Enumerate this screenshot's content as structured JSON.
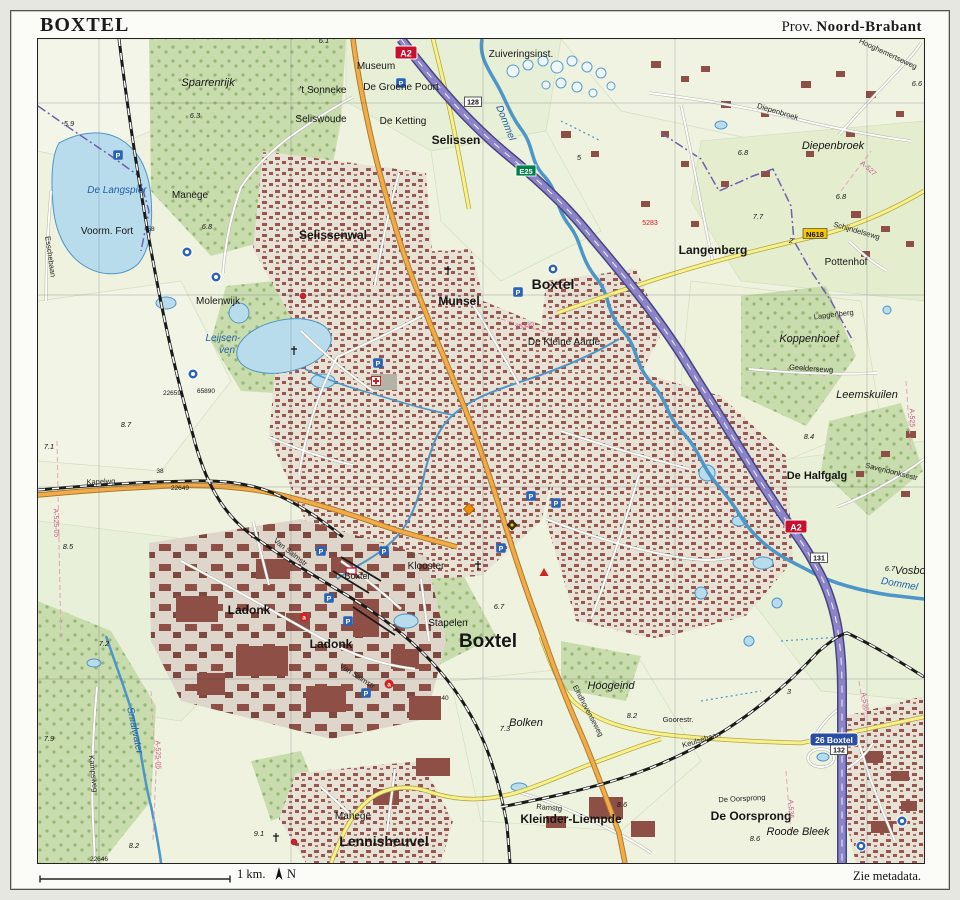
{
  "page": {
    "title": "BOXTEL",
    "province_prefix": "Prov.",
    "province": "Noord-Brabant",
    "scale_label": "1 km.",
    "north_label": "N",
    "metadata_note": "Zie metadata."
  },
  "colors": {
    "field": "#eef2de",
    "forest": "#c9dcae",
    "urban": "#e8e1d6",
    "building": "#8d4f46",
    "water_fill": "#b9dcec",
    "water_line": "#4e96c8",
    "motorway": "#8d83c9",
    "main_road": "#f3ab4a",
    "secondary_road": "#f7f08c",
    "railway": "#1a1a1a",
    "boundary": "#6f5fb0",
    "water_label": "#1f5fa8",
    "motorway_shield": "#c8102e",
    "eroad_shield": "#00804a",
    "nroad_shield": "#f6c800",
    "exit_sign": "#2b4ea2"
  },
  "map": {
    "labels": [
      {
        "text": "Sparrenrijk",
        "x": 207,
        "y": 85,
        "cls": "area"
      },
      {
        "text": "Museum",
        "x": 375,
        "y": 68,
        "cls": "hamlet"
      },
      {
        "text": "'t Sonneke",
        "x": 322,
        "y": 92,
        "cls": "hamlet"
      },
      {
        "text": "De Groene Poort",
        "x": 400,
        "y": 89,
        "cls": "hamlet"
      },
      {
        "text": "Seliswoude",
        "x": 320,
        "y": 121,
        "cls": "hamlet"
      },
      {
        "text": "De Ketting",
        "x": 402,
        "y": 123,
        "cls": "hamlet"
      },
      {
        "text": "Selissen",
        "x": 455,
        "y": 143,
        "cls": "village"
      },
      {
        "text": "Zuiveringsinst.",
        "x": 520,
        "y": 56,
        "cls": "hamlet"
      },
      {
        "text": "Manege",
        "x": 189,
        "y": 197,
        "cls": "hamlet"
      },
      {
        "text": "Voorm. Fort",
        "x": 106,
        "y": 233,
        "cls": "hamlet"
      },
      {
        "text": "De Langspier",
        "x": 116,
        "y": 192,
        "cls": "water"
      },
      {
        "text": "Selissenwal",
        "x": 332,
        "y": 238,
        "cls": "village"
      },
      {
        "text": "Molenwijk",
        "x": 217,
        "y": 303,
        "cls": "hamlet"
      },
      {
        "text": "Leijsen-",
        "x": 222,
        "y": 340,
        "cls": "water"
      },
      {
        "text": "ven",
        "x": 226,
        "y": 352,
        "cls": "water"
      },
      {
        "text": "Munsel",
        "x": 458,
        "y": 304,
        "cls": "village"
      },
      {
        "text": "Boxtel",
        "x": 552,
        "y": 288,
        "cls": "town-lg"
      },
      {
        "text": "De Kleine Aarde",
        "x": 563,
        "y": 344,
        "cls": "hamlet"
      },
      {
        "text": "Langenberg",
        "x": 712,
        "y": 253,
        "cls": "village"
      },
      {
        "text": "Pottenhof",
        "x": 845,
        "y": 264,
        "cls": "hamlet"
      },
      {
        "text": "Diepenbroek",
        "x": 832,
        "y": 148,
        "cls": "area"
      },
      {
        "text": "Koppenhoef",
        "x": 808,
        "y": 341,
        "cls": "area"
      },
      {
        "text": "Leemskuilen",
        "x": 866,
        "y": 397,
        "cls": "area"
      },
      {
        "text": "De Halfgalg",
        "x": 816,
        "y": 478,
        "cls": "subarea"
      },
      {
        "text": "Klooster",
        "x": 425,
        "y": 568,
        "cls": "hamlet"
      },
      {
        "text": "Stapelen",
        "x": 447,
        "y": 625,
        "cls": "hamlet"
      },
      {
        "text": "Boxtel",
        "x": 487,
        "y": 646,
        "cls": "town-xl"
      },
      {
        "text": "Ladonk",
        "x": 248,
        "y": 613,
        "cls": "village"
      },
      {
        "text": "Ladonk",
        "x": 330,
        "y": 647,
        "cls": "village"
      },
      {
        "text": "Boxtel",
        "x": 356,
        "y": 578,
        "cls": "station-lbl"
      },
      {
        "text": "Hoogeind",
        "x": 610,
        "y": 688,
        "cls": "area"
      },
      {
        "text": "Bolken",
        "x": 525,
        "y": 725,
        "cls": "area"
      },
      {
        "text": "Goorestr.",
        "x": 677,
        "y": 721,
        "cls": "street"
      },
      {
        "text": "Kleinder-Liempde",
        "x": 570,
        "y": 822,
        "cls": "village"
      },
      {
        "text": "Lennisheuvel",
        "x": 383,
        "y": 845,
        "cls": "town-lg"
      },
      {
        "text": "Manege",
        "x": 352,
        "y": 818,
        "cls": "hamlet"
      },
      {
        "text": "De Oorsprong",
        "x": 750,
        "y": 819,
        "cls": "village"
      },
      {
        "text": "Roode Bleek",
        "x": 797,
        "y": 834,
        "cls": "area"
      },
      {
        "text": "Vosbos",
        "x": 912,
        "y": 573,
        "cls": "area"
      },
      {
        "text": "Dommel",
        "x": 502,
        "y": 123,
        "cls": "water",
        "rot": 68
      },
      {
        "text": "Dommel",
        "x": 898,
        "y": 586,
        "cls": "water",
        "rot": 10
      },
      {
        "text": "Smalwater",
        "x": 131,
        "y": 730,
        "cls": "water",
        "rot": 78
      },
      {
        "text": "Hooghemertseweg",
        "x": 886,
        "y": 55,
        "cls": "street",
        "rot": 25
      },
      {
        "text": "Diepenbroek",
        "x": 776,
        "y": 113,
        "cls": "street",
        "rot": 17
      },
      {
        "text": "Schijndelsewg",
        "x": 855,
        "y": 232,
        "cls": "street",
        "rot": 16
      },
      {
        "text": "Langenberg",
        "x": 833,
        "y": 316,
        "cls": "street",
        "rot": -7
      },
      {
        "text": "Geeldersewg",
        "x": 810,
        "y": 370,
        "cls": "street",
        "rot": 4
      },
      {
        "text": "Savendonksestr",
        "x": 890,
        "y": 473,
        "cls": "street",
        "rot": 14
      },
      {
        "text": "Kapelwg",
        "x": 100,
        "y": 483,
        "cls": "street",
        "rot": -2
      },
      {
        "text": "Esschebaan",
        "x": 47,
        "y": 256,
        "cls": "street",
        "rot": 82
      },
      {
        "text": "Kampsweg",
        "x": 90,
        "y": 773,
        "cls": "street",
        "rot": 84
      },
      {
        "text": "Eindhovenseweg",
        "x": 585,
        "y": 711,
        "cls": "street",
        "rot": 62
      },
      {
        "text": "Keulsebaan",
        "x": 701,
        "y": 741,
        "cls": "street",
        "rot": -17
      },
      {
        "text": "Van Salmstr",
        "x": 288,
        "y": 553,
        "cls": "street",
        "rot": 38
      },
      {
        "text": "Van Salmstr",
        "x": 355,
        "y": 677,
        "cls": "street",
        "rot": 33
      },
      {
        "text": "Ramstg",
        "x": 548,
        "y": 809,
        "cls": "street",
        "rot": 5
      },
      {
        "text": "De Oorsprong",
        "x": 741,
        "y": 800,
        "cls": "street",
        "rot": -3
      },
      {
        "text": "6.1",
        "x": 323,
        "y": 42,
        "cls": "spot"
      },
      {
        "text": "5.9",
        "x": 68,
        "y": 125,
        "cls": "spot"
      },
      {
        "text": "6.3",
        "x": 194,
        "y": 117,
        "cls": "spot"
      },
      {
        "text": "5",
        "x": 578,
        "y": 159,
        "cls": "spot"
      },
      {
        "text": "6.8",
        "x": 742,
        "y": 154,
        "cls": "spot"
      },
      {
        "text": "6.8",
        "x": 840,
        "y": 198,
        "cls": "spot"
      },
      {
        "text": "7.7",
        "x": 757,
        "y": 218,
        "cls": "spot"
      },
      {
        "text": "6.8",
        "x": 206,
        "y": 228,
        "cls": "spot"
      },
      {
        "text": "8.7",
        "x": 125,
        "y": 426,
        "cls": "spot"
      },
      {
        "text": "7.1",
        "x": 48,
        "y": 448,
        "cls": "spot"
      },
      {
        "text": "8.5",
        "x": 67,
        "y": 548,
        "cls": "spot"
      },
      {
        "text": "8.4",
        "x": 808,
        "y": 438,
        "cls": "spot"
      },
      {
        "text": "6.7",
        "x": 498,
        "y": 608,
        "cls": "spot"
      },
      {
        "text": "6.7",
        "x": 889,
        "y": 570,
        "cls": "spot"
      },
      {
        "text": "7.2",
        "x": 103,
        "y": 645,
        "cls": "spot"
      },
      {
        "text": "7.9",
        "x": 48,
        "y": 740,
        "cls": "spot"
      },
      {
        "text": "8.2",
        "x": 133,
        "y": 847,
        "cls": "spot"
      },
      {
        "text": "8.2",
        "x": 631,
        "y": 717,
        "cls": "spot"
      },
      {
        "text": "7.3",
        "x": 504,
        "y": 730,
        "cls": "spot"
      },
      {
        "text": "8.6",
        "x": 621,
        "y": 806,
        "cls": "spot"
      },
      {
        "text": "8.6",
        "x": 754,
        "y": 840,
        "cls": "spot"
      },
      {
        "text": "9.1",
        "x": 258,
        "y": 835,
        "cls": "spot"
      },
      {
        "text": "6.6",
        "x": 916,
        "y": 85,
        "cls": "spot"
      },
      {
        "text": "2",
        "x": 790,
        "y": 242,
        "cls": "spot"
      },
      {
        "text": "3",
        "x": 788,
        "y": 693,
        "cls": "spot"
      },
      {
        "text": "58",
        "x": 150,
        "y": 230,
        "cls": "tiny"
      },
      {
        "text": "38",
        "x": 159,
        "y": 472,
        "cls": "tiny"
      },
      {
        "text": "40",
        "x": 444,
        "y": 699,
        "cls": "tiny"
      },
      {
        "text": "22659",
        "x": 171,
        "y": 394,
        "cls": "tiny"
      },
      {
        "text": "65890",
        "x": 205,
        "y": 392,
        "cls": "tiny"
      },
      {
        "text": "22649",
        "x": 179,
        "y": 489,
        "cls": "tiny"
      },
      {
        "text": "22646",
        "x": 98,
        "y": 860,
        "cls": "tiny"
      },
      {
        "text": "5283",
        "x": 649,
        "y": 224,
        "cls": "red"
      },
      {
        "text": "A-527",
        "x": 866,
        "y": 169,
        "cls": "pink",
        "rot": 42
      },
      {
        "text": "A-525",
        "x": 909,
        "y": 417,
        "cls": "pink",
        "rot": 88
      },
      {
        "text": "A-525-05",
        "x": 155,
        "y": 754,
        "cls": "pink",
        "rot": 88
      },
      {
        "text": "A-525-05",
        "x": 53,
        "y": 522,
        "cls": "pink",
        "rot": 88
      },
      {
        "text": "A-536",
        "x": 788,
        "y": 808,
        "cls": "pink",
        "rot": 88
      },
      {
        "text": "A-536",
        "x": 862,
        "y": 701,
        "cls": "pink",
        "rot": 80
      },
      {
        "text": "25330",
        "x": 524,
        "y": 327,
        "cls": "pink",
        "rot": -10
      }
    ],
    "icons": [
      {
        "type": "motorway-shield",
        "label": "A2",
        "x": 405,
        "y": 52
      },
      {
        "type": "motorway-shield",
        "label": "A2",
        "x": 795,
        "y": 526
      },
      {
        "type": "eroad-shield",
        "label": "E25",
        "x": 525,
        "y": 170
      },
      {
        "type": "nroad-shield",
        "label": "N618",
        "x": 814,
        "y": 233
      },
      {
        "type": "exit-sign",
        "label": "26 Boxtel",
        "x": 833,
        "y": 739
      },
      {
        "type": "km-box",
        "label": "128",
        "x": 472,
        "y": 101
      },
      {
        "type": "km-box",
        "label": "131",
        "x": 818,
        "y": 557
      },
      {
        "type": "km-box",
        "label": "132",
        "x": 838,
        "y": 749
      },
      {
        "type": "parking",
        "label": "P",
        "x": 117,
        "y": 154
      },
      {
        "type": "parking",
        "label": "P",
        "x": 400,
        "y": 82
      },
      {
        "type": "parking",
        "label": "P",
        "x": 517,
        "y": 291
      },
      {
        "type": "parking",
        "label": "P",
        "x": 377,
        "y": 362
      },
      {
        "type": "parking",
        "label": "P",
        "x": 530,
        "y": 495
      },
      {
        "type": "parking",
        "label": "P",
        "x": 555,
        "y": 502
      },
      {
        "type": "parking",
        "label": "P",
        "x": 500,
        "y": 547
      },
      {
        "type": "parking",
        "label": "P",
        "x": 383,
        "y": 550
      },
      {
        "type": "parking",
        "label": "P",
        "x": 320,
        "y": 550
      },
      {
        "type": "parking",
        "label": "P",
        "x": 328,
        "y": 597
      },
      {
        "type": "parking",
        "label": "P",
        "x": 347,
        "y": 620
      },
      {
        "type": "parking",
        "label": "P",
        "x": 365,
        "y": 692
      },
      {
        "type": "poi-circle",
        "x": 186,
        "y": 251
      },
      {
        "type": "poi-circle",
        "x": 215,
        "y": 276
      },
      {
        "type": "poi-circle",
        "x": 192,
        "y": 373
      },
      {
        "type": "poi-circle",
        "x": 552,
        "y": 268
      },
      {
        "type": "poi-circle",
        "x": 901,
        "y": 820
      },
      {
        "type": "poi-circle",
        "x": 860,
        "y": 845
      },
      {
        "type": "poi-a",
        "label": "a",
        "x": 303,
        "y": 616
      },
      {
        "type": "poi-a",
        "label": "a",
        "x": 388,
        "y": 683
      },
      {
        "type": "hospital",
        "x": 375,
        "y": 380
      },
      {
        "type": "church",
        "x": 447,
        "y": 270
      },
      {
        "type": "church",
        "x": 293,
        "y": 350
      },
      {
        "type": "church",
        "x": 275,
        "y": 837
      },
      {
        "type": "church",
        "x": 477,
        "y": 565
      },
      {
        "type": "diamond-orange",
        "x": 468,
        "y": 508
      },
      {
        "type": "diamond-dark",
        "x": 511,
        "y": 524
      },
      {
        "type": "triangle-red",
        "x": 543,
        "y": 572
      },
      {
        "type": "dot-red",
        "x": 302,
        "y": 295
      },
      {
        "type": "dot-red",
        "x": 293,
        "y": 841
      },
      {
        "type": "station",
        "x": 350,
        "y": 570
      }
    ]
  }
}
